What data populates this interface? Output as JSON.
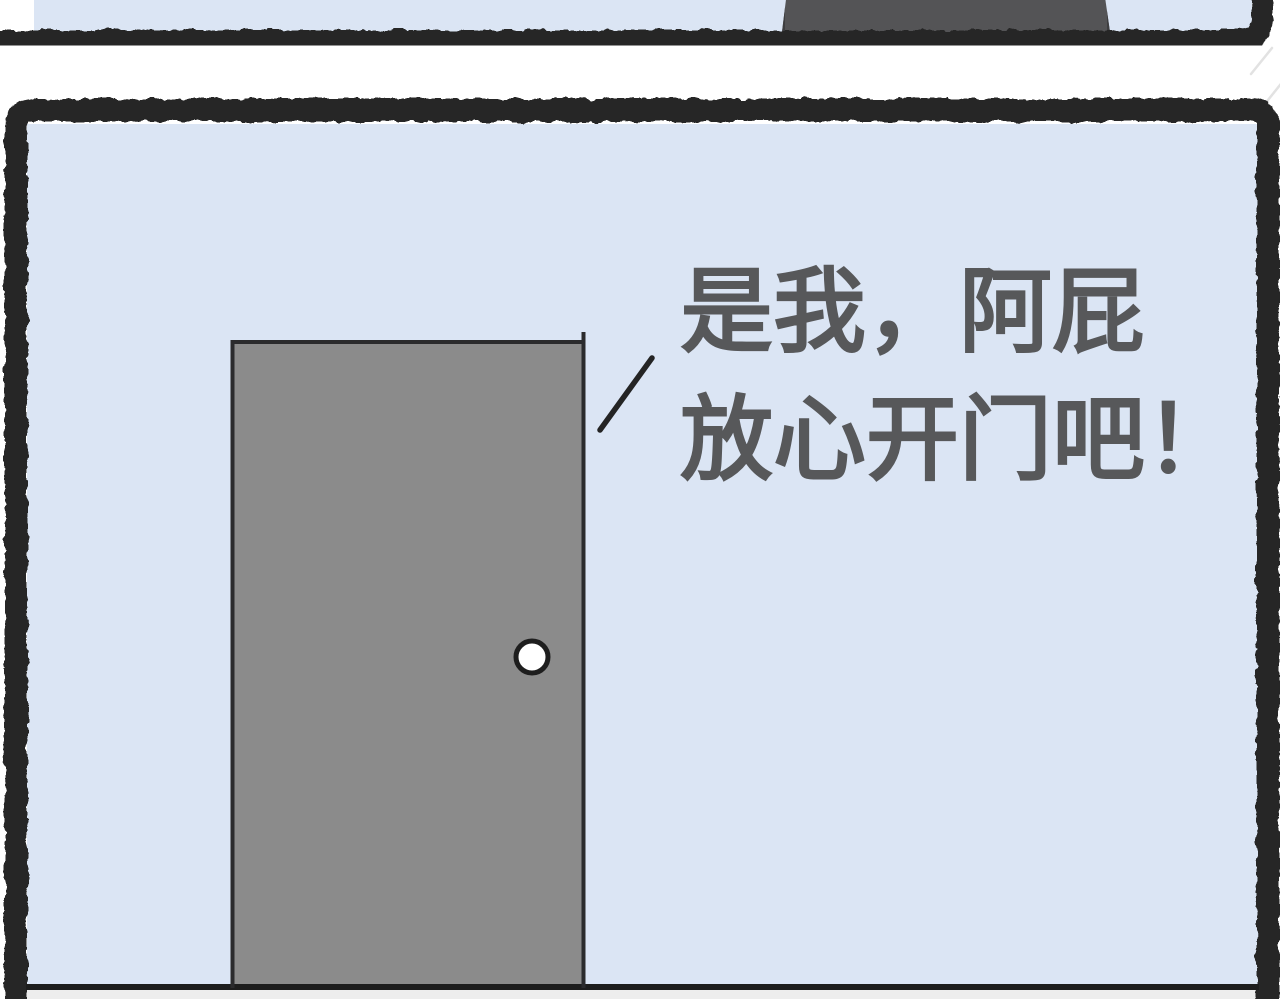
{
  "page": {
    "width": 1280,
    "height": 999,
    "background": "#ffffff"
  },
  "colors": {
    "wall": "#dbe5f4",
    "door": "#8b8b8b",
    "door_top": "#545456",
    "ink": "#282828",
    "floor": "#ededed",
    "floor_line": "#1d1d1d",
    "text": "#57585a",
    "knob": "#ffffff",
    "scratch": "#e2e2e2",
    "door_edge": "#2b2b2d"
  },
  "panel_main": {
    "speech": {
      "line1": "是我，阿屁",
      "line2": "放心开门吧！"
    }
  }
}
